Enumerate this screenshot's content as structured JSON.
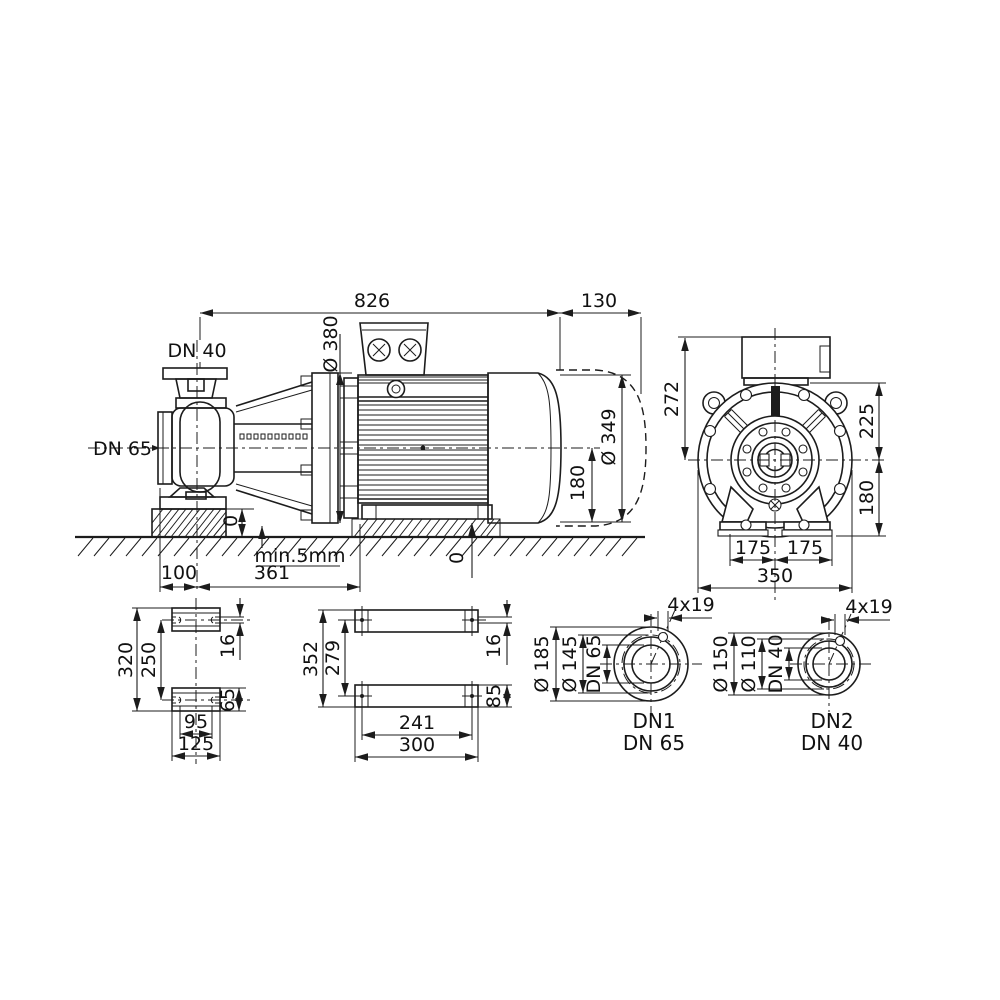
{
  "colors": {
    "line": "#1c1c1c",
    "background": "#ffffff"
  },
  "side": {
    "d826": "826",
    "d130": "130",
    "d380": "Ø 380",
    "dn40": "DN 40",
    "dn65": "DN 65",
    "d349": "Ø 349",
    "d180": "180",
    "zeroL": "0",
    "zeroR": "0",
    "grout": "min.5mm",
    "d361": "361",
    "d100": "100"
  },
  "end": {
    "d272": "272",
    "d225": "225",
    "d180": "180",
    "d175a": "175",
    "d175b": "175",
    "d350": "350"
  },
  "pumpfeet": {
    "d320": "320",
    "d250": "250",
    "d16": "16",
    "d65": "65",
    "d95": "95",
    "d125": "125"
  },
  "motorfeet": {
    "d352": "352",
    "d279": "279",
    "d16": "16",
    "d85": "85",
    "d241": "241",
    "d300": "300"
  },
  "flange1": {
    "outer": "Ø 185",
    "bolt": "Ø 145",
    "bore": "DN 65",
    "holes": "4x19",
    "name": "DN1",
    "size": "DN 65"
  },
  "flange2": {
    "outer": "Ø 150",
    "bolt": "Ø 110",
    "bore": "DN 40",
    "holes": "4x19",
    "name": "DN2",
    "size": "DN 40"
  }
}
